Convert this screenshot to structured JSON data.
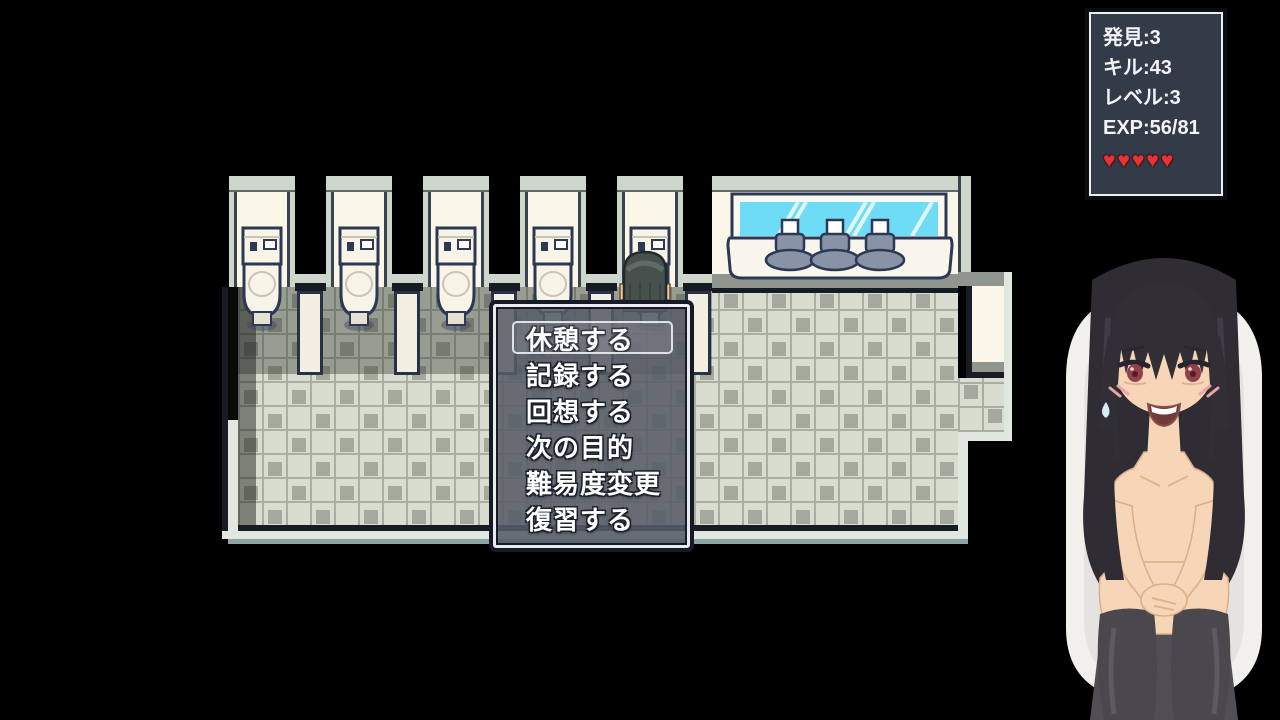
{
  "hud": {
    "stats": [
      {
        "id": "discoveries",
        "label": "発見:3"
      },
      {
        "id": "kills",
        "label": "キル:43"
      },
      {
        "id": "level",
        "label": "レベル:3"
      },
      {
        "id": "exp",
        "label": "EXP:56/81"
      }
    ],
    "hearts": "♥♥♥♥♥",
    "hearts_count": 5
  },
  "menu": {
    "items": [
      {
        "label": "休憩する",
        "selected": true
      },
      {
        "label": "記録する",
        "selected": false
      },
      {
        "label": "回想する",
        "selected": false
      },
      {
        "label": "次の目的",
        "selected": false
      },
      {
        "label": "難易度変更",
        "selected": false
      },
      {
        "label": "復習する",
        "selected": false
      }
    ],
    "selected_index": 0
  },
  "scene": {
    "description": "RPG restroom map with five toilet stalls, sink counter with mirror, player sprite, checkered tile floor",
    "colors": {
      "background": "#000000",
      "wall_light": "#ccd6cb",
      "wall_cream": "#faf7e9",
      "tile_base": "#d8ddcf",
      "tile_square": "#a5a99d",
      "outline_navy": "#273246",
      "mirror_cyan": "#6edcf5",
      "menu_fill": "rgba(86,92,104,0.88)",
      "hud_bg": "#333a48",
      "heart_red": "#e63434"
    }
  }
}
